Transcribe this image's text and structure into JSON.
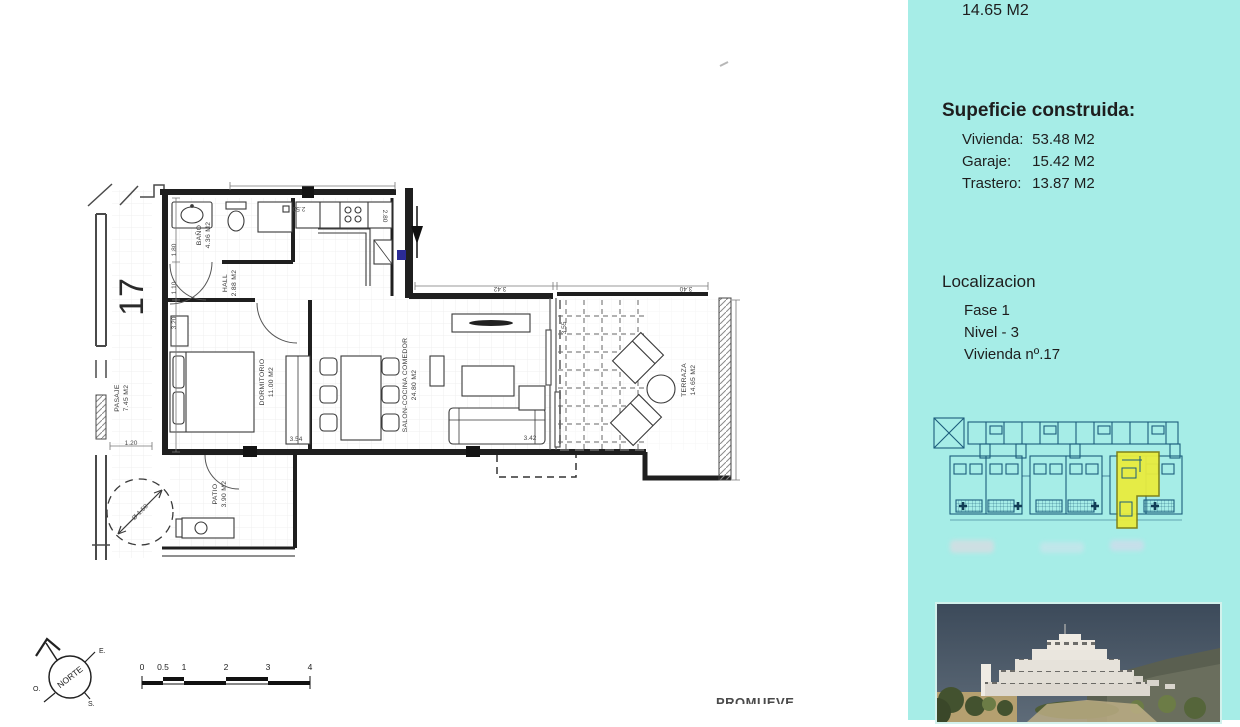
{
  "page": {
    "promueve": "PROMUEVE"
  },
  "panel": {
    "accent_color": "#a6ede7",
    "top_value": "14.65 M2",
    "superficie": {
      "title": "Supeficie construida:",
      "rows": [
        {
          "label": "Vivienda:",
          "value": "53.48 M2"
        },
        {
          "label": "Garaje:",
          "value": "15.42 M2"
        },
        {
          "label": "Trastero:",
          "value": "13.87 M2"
        }
      ]
    },
    "localizacion": {
      "title": "Localizacion",
      "rows": [
        "Fase 1",
        "Nivel - 3",
        "Vivienda nº.17"
      ]
    },
    "siteplan_highlight_color": "#e9ec3e"
  },
  "plan": {
    "unit_number": "17",
    "rooms": {
      "bano": {
        "name": "BAÑO",
        "area": "4.36 M2"
      },
      "hall": {
        "name": "HALL",
        "area": "2.88 M2"
      },
      "dormitorio": {
        "name": "DORMITORIO",
        "area": "11.00 M2"
      },
      "salon": {
        "name": "SALON-COCINA COMEDOR",
        "area": "24.80 M2"
      },
      "terraza": {
        "name": "TERRAZA",
        "area": "14.65 M2"
      },
      "pasaje": {
        "name": "PASAJE",
        "area": "7.45 M2"
      },
      "patio": {
        "name": "PATIO",
        "area": "3.90 M2"
      }
    },
    "dimensions": {
      "d180": "1.80",
      "d110": "1.10",
      "d320": "3.20",
      "d250": "2.50",
      "d280": "2.80",
      "d342a": "3.42",
      "d355": "3.55",
      "d340": "3.40",
      "d354": "3.54",
      "d342b": "3.42",
      "d120": "1.20",
      "diam": "Ø 1.50"
    },
    "compass": {
      "label": "NORTE",
      "east": "E.",
      "south": "S.",
      "west": "O."
    },
    "scale_ticks": [
      "0",
      "0.5",
      "1",
      "2",
      "3",
      "4"
    ]
  }
}
